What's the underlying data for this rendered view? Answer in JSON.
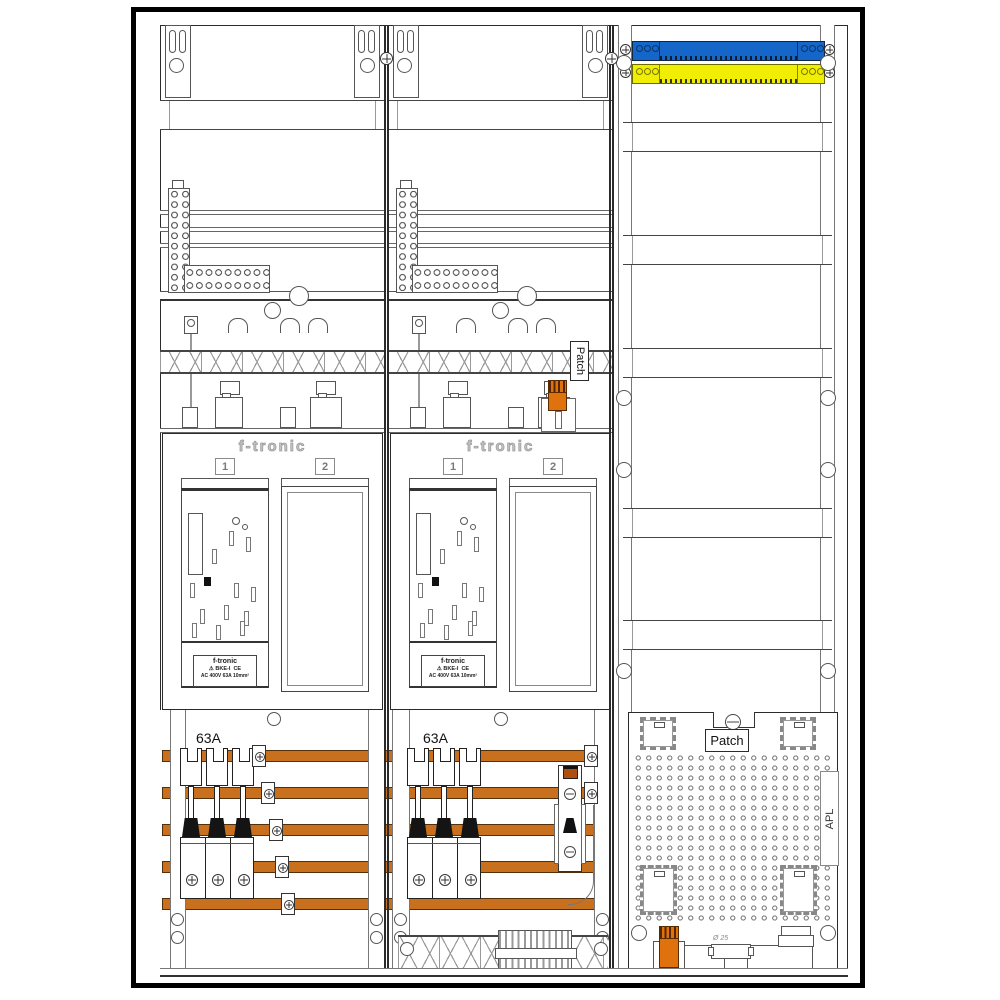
{
  "diagram": {
    "type": "electrical-meter-cabinet-drawing",
    "brand": "f-tronic",
    "meter_fields": {
      "field1": "1",
      "field2": "2"
    },
    "plate": {
      "name": "f-tronic",
      "warn": "⚠",
      "cert": "BKE-I",
      "ce": "CE",
      "rating": "AC 400V   63A   10mm²"
    },
    "labels": {
      "amp_col1": "63A",
      "amp_col2": "63A",
      "patch_vertical": "Patch",
      "patch_panel": "Patch",
      "apl": "APL",
      "pipe_diameter": "Ø 25"
    },
    "colors": {
      "blue_busbar": "#1566c9",
      "yellow_busbar": "#f0ee04",
      "copper_busbar": "#c8701e",
      "orange_module": "#e0720e",
      "outline": "#222222"
    }
  }
}
